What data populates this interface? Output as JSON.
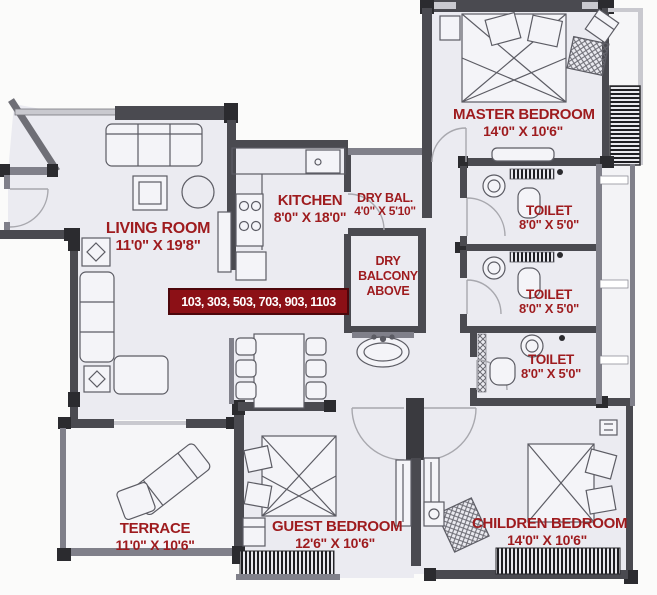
{
  "floor_plan": {
    "unit_numbers": "103, 303, 503, 703, 903, 1103",
    "rooms": {
      "living_room": {
        "name": "LIVING ROOM",
        "dims": "11'0\" X 19'8\""
      },
      "kitchen": {
        "name": "KITCHEN",
        "dims": "8'0\" X 18'0\""
      },
      "dry_balcony": {
        "name": "DRY BAL.",
        "dims": "4'0\" X 5'10\""
      },
      "dry_balcony_above": {
        "name": "DRY BALCONY ABOVE"
      },
      "master_bedroom": {
        "name": "MASTER BEDROOM",
        "dims": "14'0\" X 10'6\""
      },
      "toilet_1": {
        "name": "TOILET",
        "dims": "8'0\" X 5'0\""
      },
      "toilet_2": {
        "name": "TOILET",
        "dims": "8'0\" X 5'0\""
      },
      "toilet_3": {
        "name": "TOILET",
        "dims": "8'0\" X 5'0\""
      },
      "terrace": {
        "name": "TERRACE",
        "dims": "11'0\" X 10'6\""
      },
      "guest_bedroom": {
        "name": "GUEST BEDROOM",
        "dims": "12'6\" X 10'6\""
      },
      "children_bedroom": {
        "name": "CHILDREN BEDROOM",
        "dims": "14'0\" X 10'6\""
      }
    },
    "colors": {
      "label_text": "#9e1b1e",
      "unit_band_bg": "#8c1016",
      "unit_band_text": "#ffffff",
      "wall": "#4a4a50",
      "room_fill": "#ebebf1"
    }
  }
}
